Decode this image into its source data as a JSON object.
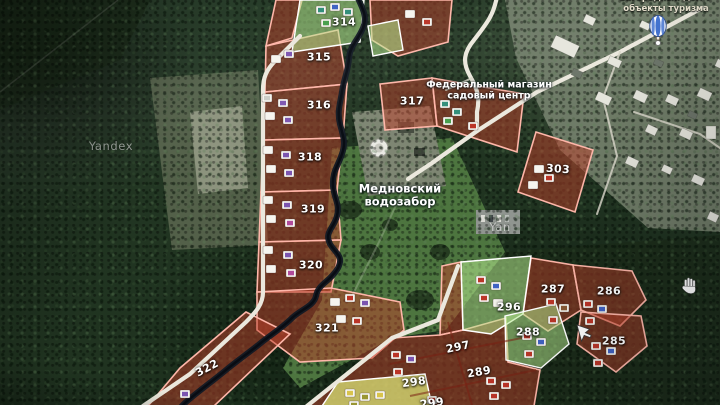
{
  "map": {
    "provider_watermarks": [
      {
        "text": "Yandex",
        "x": 111,
        "y": 146
      },
      {
        "text": "Yan",
        "x": 500,
        "y": 227
      }
    ],
    "pois": {
      "water_intake": {
        "line1": "Медновский",
        "line2": "водозабор"
      },
      "garden_center": {
        "line1": "Федеральный магазин",
        "line2": "садовый центр"
      },
      "tourism": {
        "line1": "Загородный дом У",
        "line2": "объекты туризма",
        "icon": "hot-air-balloon-icon"
      }
    },
    "parcels": [
      {
        "number": "314",
        "x": 344,
        "y": 22,
        "rot": 0,
        "zone": "green"
      },
      {
        "number": "315",
        "x": 319,
        "y": 57,
        "rot": 0,
        "zone": "red"
      },
      {
        "number": "316",
        "x": 319,
        "y": 105,
        "rot": 0,
        "zone": "red"
      },
      {
        "number": "317",
        "x": 412,
        "y": 101,
        "rot": 0,
        "zone": "red"
      },
      {
        "number": "318",
        "x": 310,
        "y": 157,
        "rot": 0,
        "zone": "red"
      },
      {
        "number": "319",
        "x": 313,
        "y": 209,
        "rot": 0,
        "zone": "red"
      },
      {
        "number": "320",
        "x": 311,
        "y": 265,
        "rot": 0,
        "zone": "red"
      },
      {
        "number": "321",
        "x": 327,
        "y": 328,
        "rot": 0,
        "zone": "red"
      },
      {
        "number": "322",
        "x": 207,
        "y": 368,
        "rot": -28,
        "zone": "red"
      },
      {
        "number": "303",
        "x": 558,
        "y": 169,
        "rot": 4,
        "zone": "red"
      },
      {
        "number": "296",
        "x": 509,
        "y": 307,
        "rot": 0,
        "zone": "green"
      },
      {
        "number": "287",
        "x": 553,
        "y": 289,
        "rot": 0,
        "zone": "red"
      },
      {
        "number": "286",
        "x": 609,
        "y": 291,
        "rot": 0,
        "zone": "red"
      },
      {
        "number": "288",
        "x": 528,
        "y": 332,
        "rot": 0,
        "zone": "green"
      },
      {
        "number": "285",
        "x": 614,
        "y": 341,
        "rot": 0,
        "zone": "red"
      },
      {
        "number": "297",
        "x": 458,
        "y": 347,
        "rot": -12,
        "zone": "red"
      },
      {
        "number": "298",
        "x": 414,
        "y": 382,
        "rot": -8,
        "zone": "red"
      },
      {
        "number": "289",
        "x": 479,
        "y": 372,
        "rot": -10,
        "zone": "red"
      },
      {
        "number": "299",
        "x": 432,
        "y": 403,
        "rot": -8,
        "zone": "red"
      }
    ],
    "houses": [
      {
        "x": 284,
        "y": 50,
        "roof": "violet"
      },
      {
        "x": 271,
        "y": 55,
        "roof": "white"
      },
      {
        "x": 262,
        "y": 94,
        "roof": "gray"
      },
      {
        "x": 278,
        "y": 99,
        "roof": "violet"
      },
      {
        "x": 265,
        "y": 112,
        "roof": "white"
      },
      {
        "x": 283,
        "y": 116,
        "roof": "violet"
      },
      {
        "x": 263,
        "y": 146,
        "roof": "white"
      },
      {
        "x": 281,
        "y": 151,
        "roof": "violet"
      },
      {
        "x": 266,
        "y": 165,
        "roof": "white"
      },
      {
        "x": 284,
        "y": 169,
        "roof": "violet"
      },
      {
        "x": 263,
        "y": 196,
        "roof": "white"
      },
      {
        "x": 282,
        "y": 201,
        "roof": "violet"
      },
      {
        "x": 266,
        "y": 215,
        "roof": "white"
      },
      {
        "x": 285,
        "y": 219,
        "roof": "magenta"
      },
      {
        "x": 263,
        "y": 246,
        "roof": "white"
      },
      {
        "x": 283,
        "y": 251,
        "roof": "violet"
      },
      {
        "x": 266,
        "y": 265,
        "roof": "white"
      },
      {
        "x": 286,
        "y": 269,
        "roof": "magenta"
      },
      {
        "x": 330,
        "y": 298,
        "roof": "white"
      },
      {
        "x": 345,
        "y": 294,
        "roof": "red"
      },
      {
        "x": 360,
        "y": 299,
        "roof": "violet"
      },
      {
        "x": 336,
        "y": 315,
        "roof": "white"
      },
      {
        "x": 352,
        "y": 317,
        "roof": "red"
      },
      {
        "x": 180,
        "y": 390,
        "roof": "violet"
      },
      {
        "x": 316,
        "y": 6,
        "roof": "teal"
      },
      {
        "x": 330,
        "y": 3,
        "roof": "blue"
      },
      {
        "x": 343,
        "y": 8,
        "roof": "teal"
      },
      {
        "x": 321,
        "y": 19,
        "roof": "green"
      },
      {
        "x": 405,
        "y": 10,
        "roof": "white"
      },
      {
        "x": 422,
        "y": 18,
        "roof": "red"
      },
      {
        "x": 440,
        "y": 100,
        "roof": "teal"
      },
      {
        "x": 452,
        "y": 108,
        "roof": "teal"
      },
      {
        "x": 443,
        "y": 117,
        "roof": "green"
      },
      {
        "x": 468,
        "y": 122,
        "roof": "red"
      },
      {
        "x": 534,
        "y": 165,
        "roof": "white"
      },
      {
        "x": 544,
        "y": 174,
        "roof": "red"
      },
      {
        "x": 528,
        "y": 181,
        "roof": "white"
      },
      {
        "x": 476,
        "y": 276,
        "roof": "red"
      },
      {
        "x": 491,
        "y": 282,
        "roof": "blue"
      },
      {
        "x": 479,
        "y": 294,
        "roof": "red"
      },
      {
        "x": 493,
        "y": 299,
        "roof": "white"
      },
      {
        "x": 522,
        "y": 332,
        "roof": "red"
      },
      {
        "x": 536,
        "y": 338,
        "roof": "blue"
      },
      {
        "x": 524,
        "y": 350,
        "roof": "red"
      },
      {
        "x": 546,
        "y": 298,
        "roof": "red"
      },
      {
        "x": 559,
        "y": 304,
        "roof": "brown"
      },
      {
        "x": 548,
        "y": 316,
        "roof": "red"
      },
      {
        "x": 583,
        "y": 300,
        "roof": "red"
      },
      {
        "x": 597,
        "y": 305,
        "roof": "blue"
      },
      {
        "x": 585,
        "y": 317,
        "roof": "red"
      },
      {
        "x": 591,
        "y": 342,
        "roof": "red"
      },
      {
        "x": 606,
        "y": 347,
        "roof": "blue"
      },
      {
        "x": 593,
        "y": 359,
        "roof": "red"
      },
      {
        "x": 486,
        "y": 377,
        "roof": "red"
      },
      {
        "x": 501,
        "y": 381,
        "roof": "red"
      },
      {
        "x": 489,
        "y": 392,
        "roof": "red"
      },
      {
        "x": 391,
        "y": 351,
        "roof": "red"
      },
      {
        "x": 406,
        "y": 355,
        "roof": "violet"
      },
      {
        "x": 393,
        "y": 368,
        "roof": "red"
      },
      {
        "x": 345,
        "y": 389,
        "roof": "yellow"
      },
      {
        "x": 360,
        "y": 393,
        "roof": "olive"
      },
      {
        "x": 375,
        "y": 391,
        "roof": "yellow"
      },
      {
        "x": 349,
        "y": 401,
        "roof": "olive"
      },
      {
        "x": 427,
        "y": 396,
        "roof": "red"
      }
    ],
    "village_buildings": [
      {
        "x": 552,
        "y": 40,
        "w": 26,
        "h": 13,
        "rot": 25,
        "shade": "light"
      },
      {
        "x": 584,
        "y": 16,
        "w": 11,
        "h": 8,
        "rot": 25,
        "shade": "light"
      },
      {
        "x": 640,
        "y": 22,
        "w": 10,
        "h": 7,
        "rot": 25,
        "shade": "light"
      },
      {
        "x": 608,
        "y": 58,
        "w": 13,
        "h": 8,
        "rot": 25,
        "shade": "light"
      },
      {
        "x": 716,
        "y": 60,
        "w": 8,
        "h": 8,
        "rot": 25,
        "shade": "light"
      },
      {
        "x": 572,
        "y": 70,
        "w": 10,
        "h": 7,
        "rot": 25,
        "shade": "dark"
      },
      {
        "x": 654,
        "y": 60,
        "w": 9,
        "h": 6,
        "rot": 25,
        "shade": "dark"
      },
      {
        "x": 596,
        "y": 94,
        "w": 15,
        "h": 9,
        "rot": 25,
        "shade": "light"
      },
      {
        "x": 634,
        "y": 92,
        "w": 13,
        "h": 9,
        "rot": 25,
        "shade": "light"
      },
      {
        "x": 666,
        "y": 96,
        "w": 12,
        "h": 8,
        "rot": 25,
        "shade": "light"
      },
      {
        "x": 698,
        "y": 90,
        "w": 13,
        "h": 9,
        "rot": 25,
        "shade": "light"
      },
      {
        "x": 688,
        "y": 112,
        "w": 9,
        "h": 6,
        "rot": 25,
        "shade": "dark"
      },
      {
        "x": 646,
        "y": 126,
        "w": 11,
        "h": 8,
        "rot": 25,
        "shade": "light"
      },
      {
        "x": 680,
        "y": 130,
        "w": 12,
        "h": 8,
        "rot": 25,
        "shade": "light"
      },
      {
        "x": 706,
        "y": 126,
        "w": 10,
        "h": 13,
        "rot": 0,
        "shade": "light"
      },
      {
        "x": 626,
        "y": 158,
        "w": 12,
        "h": 8,
        "rot": 25,
        "shade": "light"
      },
      {
        "x": 662,
        "y": 166,
        "w": 10,
        "h": 7,
        "rot": 25,
        "shade": "light"
      },
      {
        "x": 692,
        "y": 176,
        "w": 12,
        "h": 8,
        "rot": 25,
        "shade": "light"
      },
      {
        "x": 708,
        "y": 213,
        "w": 10,
        "h": 8,
        "rot": 25,
        "shade": "light"
      }
    ],
    "roof_colors": {
      "white": "#f4f3ec",
      "gray": "#c9ccc4",
      "violet": "#7d55b4",
      "magenta": "#b44a9e",
      "red": "#c03527",
      "blue": "#3f63c8",
      "teal": "#2f8f7a",
      "green": "#44a04a",
      "yellow": "#d8c246",
      "olive": "#99962f",
      "brown": "#8a5a34"
    },
    "colors": {
      "parcel_red_fill": "rgba(196,64,42,0.50)",
      "parcel_red_border": "#ffb4a6",
      "parcel_green_fill": "rgba(176,232,136,0.55)",
      "parcel_green_border": "#ffffff",
      "parcel_yellow_fill": "rgba(218,226,112,0.75)",
      "parcel_divider": "#7e2013",
      "river": "#141b26",
      "road": "#e9e6da",
      "forest_dark": "#203521",
      "label_white": "#ffffff"
    },
    "cursors": {
      "arrow": {
        "x": 577,
        "y": 325
      },
      "hand": {
        "x": 683,
        "y": 277
      }
    }
  }
}
